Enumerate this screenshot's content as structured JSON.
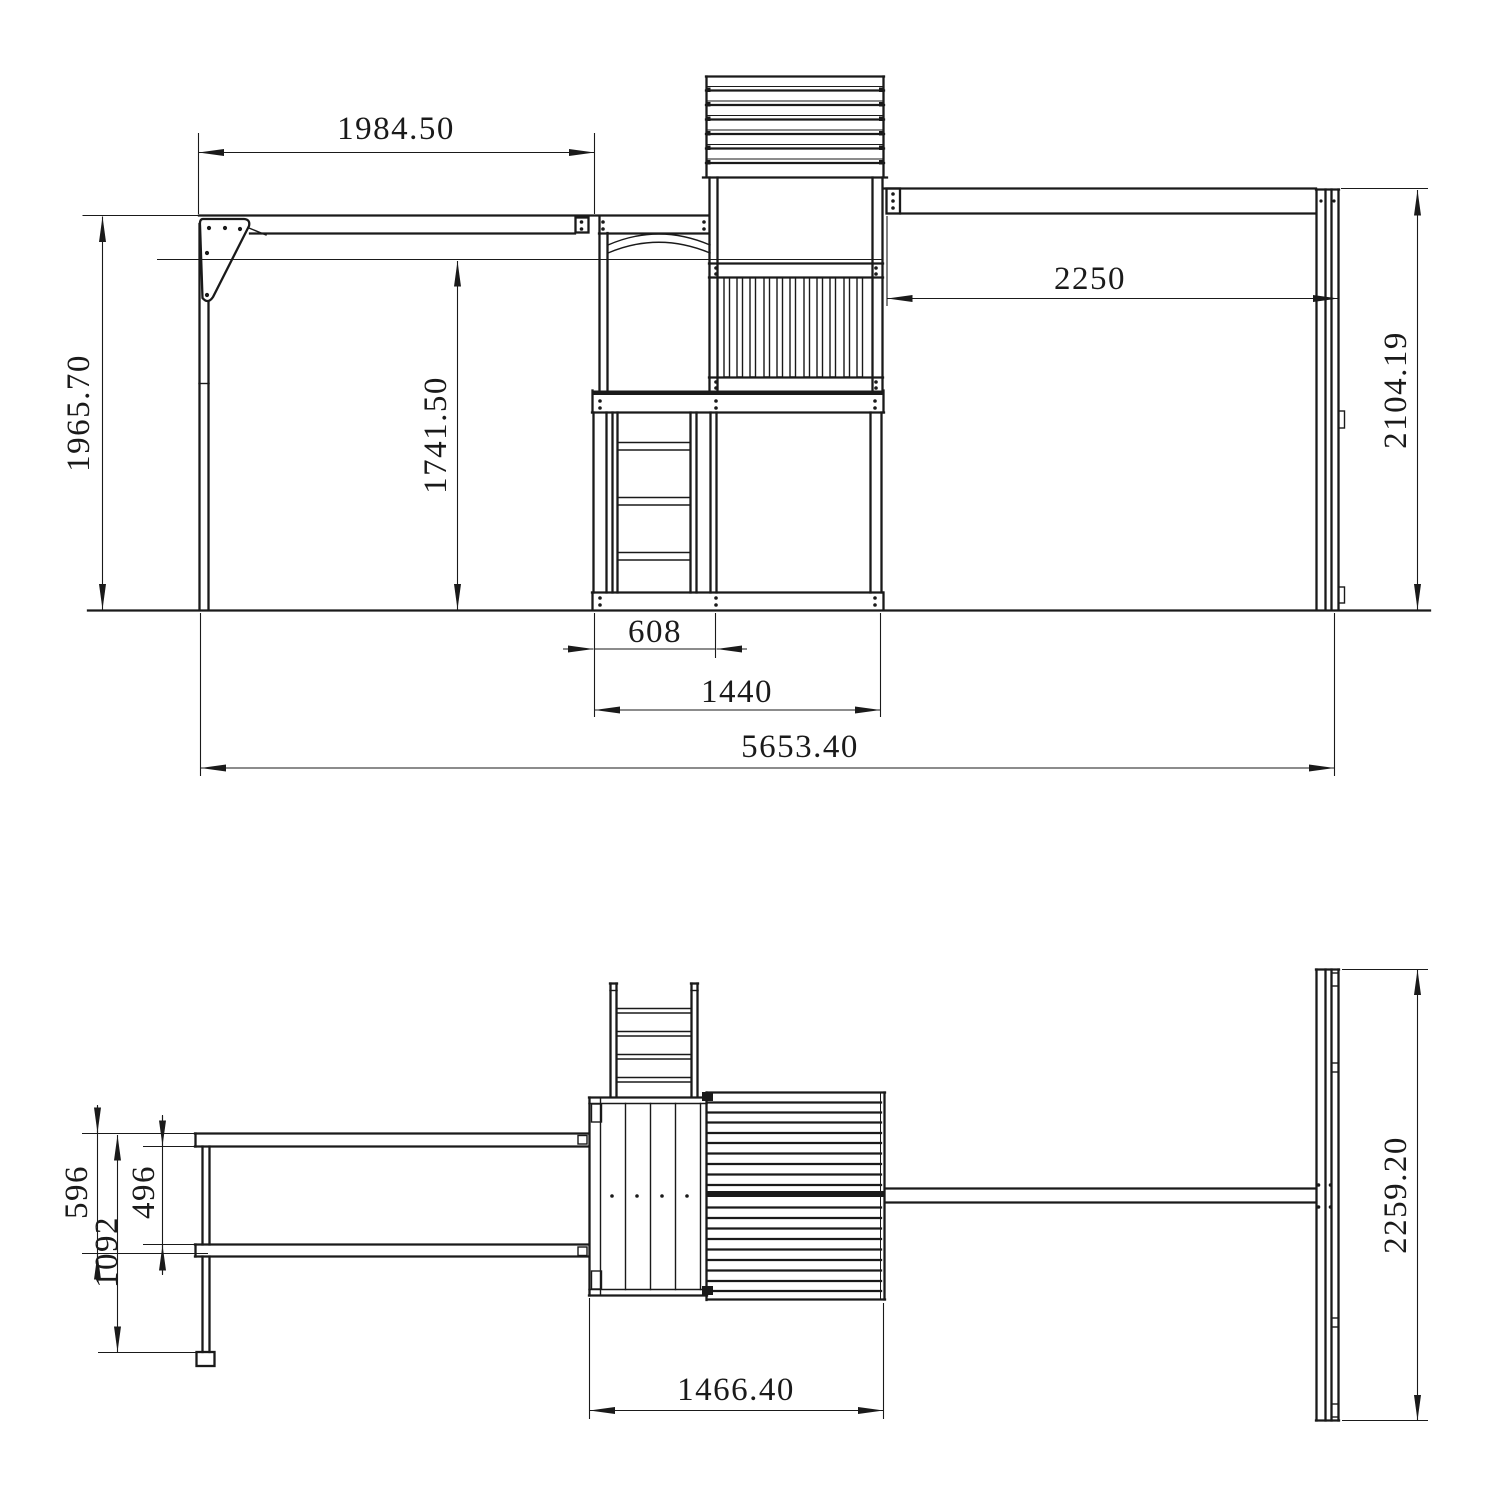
{
  "drawing": {
    "type": "technical-dimension-drawing",
    "subject": "wooden playset with swing beam, play tower with roof and ladder, and monkey-bar beam with end frame",
    "line_color": "#1a1a1a",
    "background": "#ffffff"
  },
  "front_view": {
    "dims": {
      "swing_beam_length": "1984.50",
      "swing_post_height": "1965.70",
      "platform_rail_height": "1741.50",
      "monkey_beam_length": "2250",
      "end_frame_height": "2104.19",
      "ladder_bay_width": "608",
      "tower_base_width": "1440",
      "overall_length": "5653.40"
    }
  },
  "plan_view": {
    "dims": {
      "swing_rail_offset": "596",
      "swing_rail_clear_spacing": "496",
      "swing_frame_depth": "1092",
      "tower_depth": "1466.40",
      "end_frame_width": "2259.20"
    }
  }
}
